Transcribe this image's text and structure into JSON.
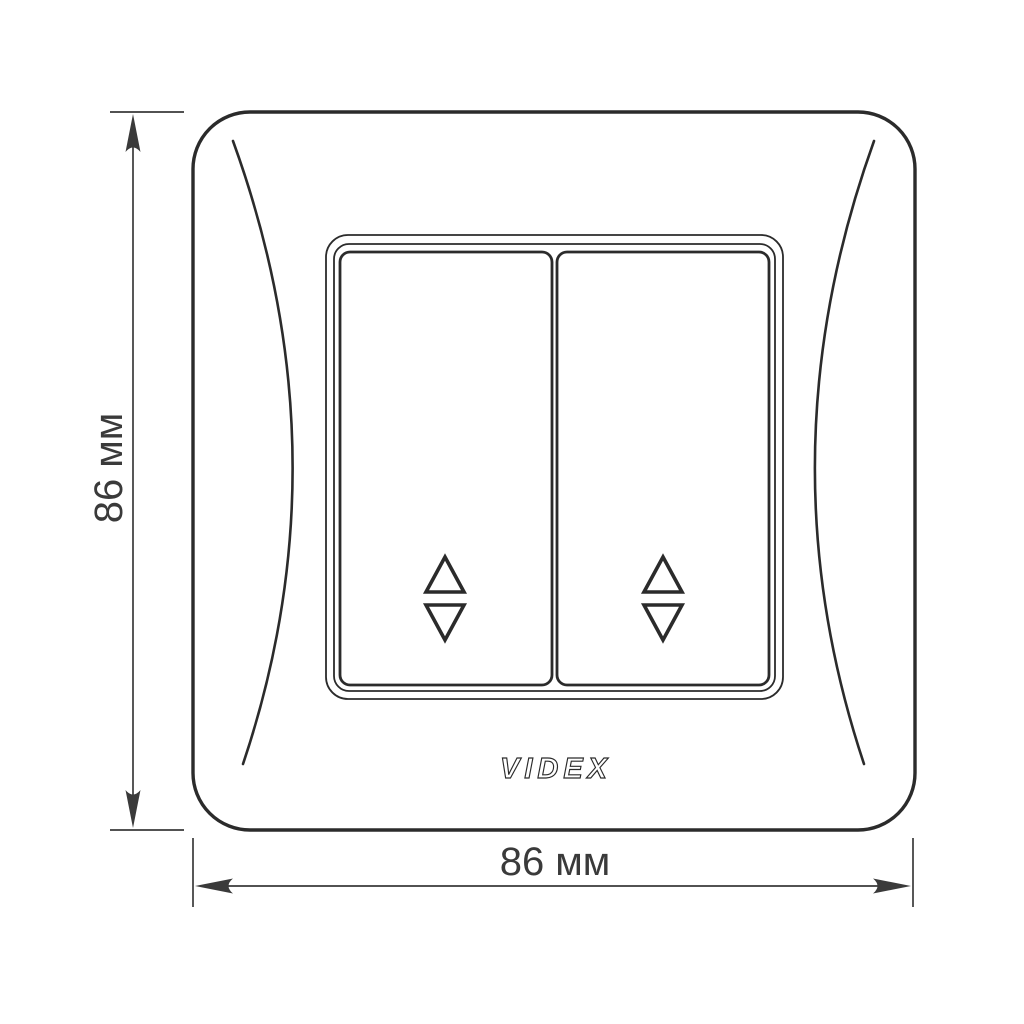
{
  "diagram": {
    "kind": "dimension-drawing",
    "logo_text": "VIDEX",
    "dimensions": {
      "height_label": "86 мм",
      "width_label": "86 мм"
    },
    "symbols": {
      "left_button_icon": "two-way-switch-up-down-triangles",
      "right_button_icon": "two-way-switch-up-down-triangles"
    },
    "colors": {
      "background": "#ffffff",
      "line": "#2b2b2b",
      "dimension": "#3a3a3a"
    }
  }
}
